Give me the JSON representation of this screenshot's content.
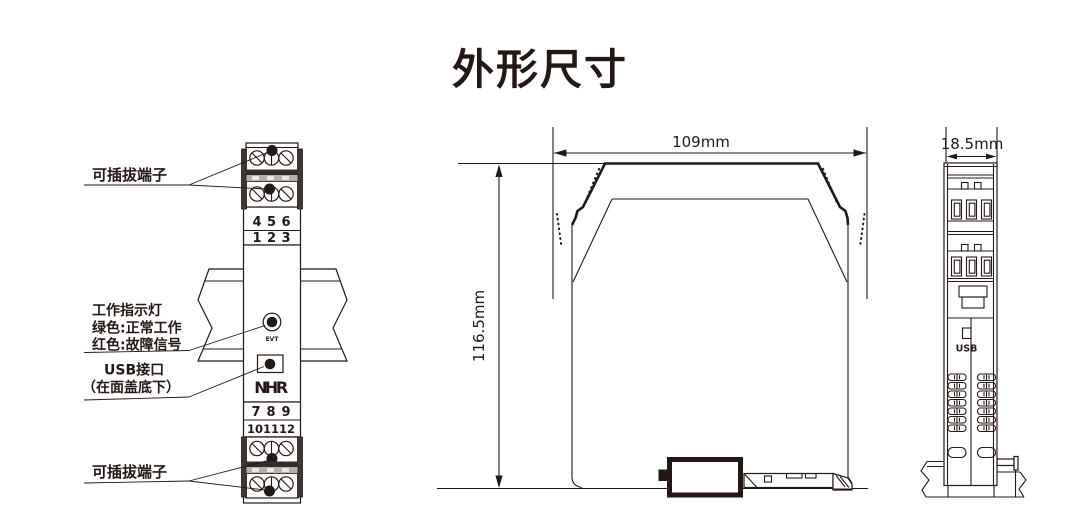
{
  "title": "外形尺寸",
  "colors": {
    "ink": "#231815",
    "red": "#e60012"
  },
  "front_view": {
    "callout_top": "可插拔端子",
    "callout_bottom": "可插拔端子",
    "indicator_lines": [
      "工作指示灯",
      "绿色:正常工作",
      "红色:故障信号"
    ],
    "usb_lines": [
      "USB接口",
      "（在面盖底下）"
    ],
    "led_label": "EVT",
    "logo_letters": [
      "N",
      "H",
      "R"
    ],
    "terminal_numbers": {
      "top_row1": [
        "4",
        "5",
        "6"
      ],
      "top_row2": [
        "1",
        "2",
        "3"
      ],
      "bottom_row1": [
        "7",
        "8",
        "9"
      ],
      "bottom_row2": [
        "10",
        "11",
        "12"
      ]
    }
  },
  "side_view": {
    "width_dim": "109mm",
    "height_dim": "116.5mm"
  },
  "end_view": {
    "width_dim": "18.5mm",
    "usb_label": "USB"
  }
}
